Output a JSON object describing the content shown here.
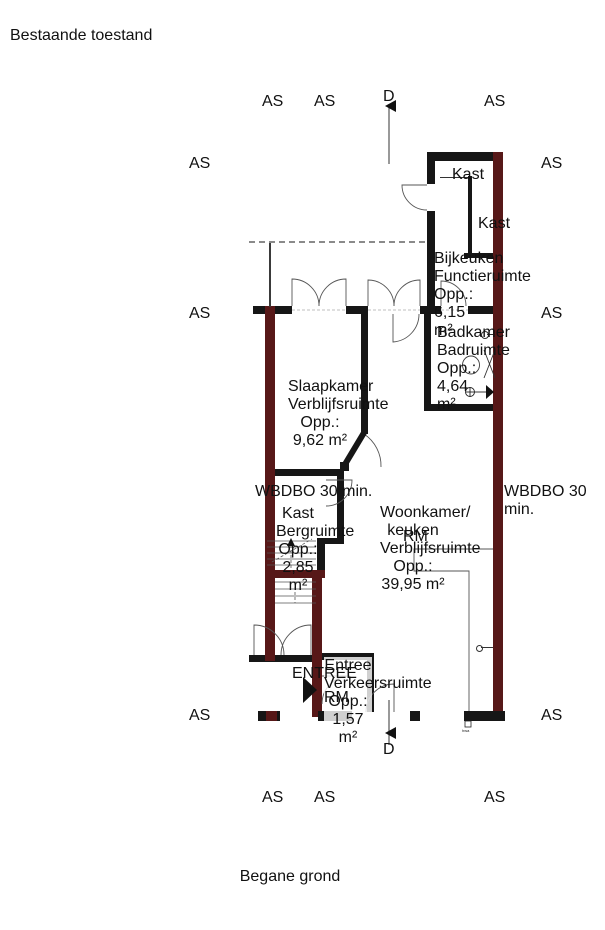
{
  "page": {
    "title": "Bestaande toestand",
    "caption": "Begane grond"
  },
  "grid": {
    "axis_label": "AS",
    "section_label": "D"
  },
  "rooms": {
    "bijkeuken": {
      "name": "Bijkeuken",
      "function": "Functieruimte",
      "area": "Opp.: 6,15 m²"
    },
    "badkamer": {
      "name": "Badkamer",
      "function": "Badruimte",
      "area": "Opp.: 4,64 m²"
    },
    "slaapkamer": {
      "name": "Slaapkamer",
      "function": "Verblijfsruimte",
      "area": "Opp.: 9,62 m²"
    },
    "kast": {
      "name": "Kast",
      "function": "Bergruimte",
      "area": "Opp.: 2,85 m²"
    },
    "woonkamer": {
      "name": "Woonkamer/ keuken",
      "function": "Verblijfsruimte",
      "area": "Opp.: 39,95 m²"
    },
    "entree": {
      "name": "Entree",
      "function": "Verkeersruimte",
      "area": "Opp.: 1,57 m²"
    }
  },
  "closets": {
    "top": "Kast",
    "side": "Kast"
  },
  "annotations": {
    "fire_rating_left": "WBDBO 30 min.",
    "fire_rating_right": "WBDBO 30 min.",
    "entrance_arrow": "ENTREE",
    "rain_drain": "hwa",
    "smoke_detector": "RM"
  },
  "colors": {
    "wall_black": "#161616",
    "fire_wall_red": "#571818",
    "neighbor_gray": "#e9e9ec",
    "grid_line": "#b9bcc4",
    "accent_red": "#cc2a2a"
  }
}
